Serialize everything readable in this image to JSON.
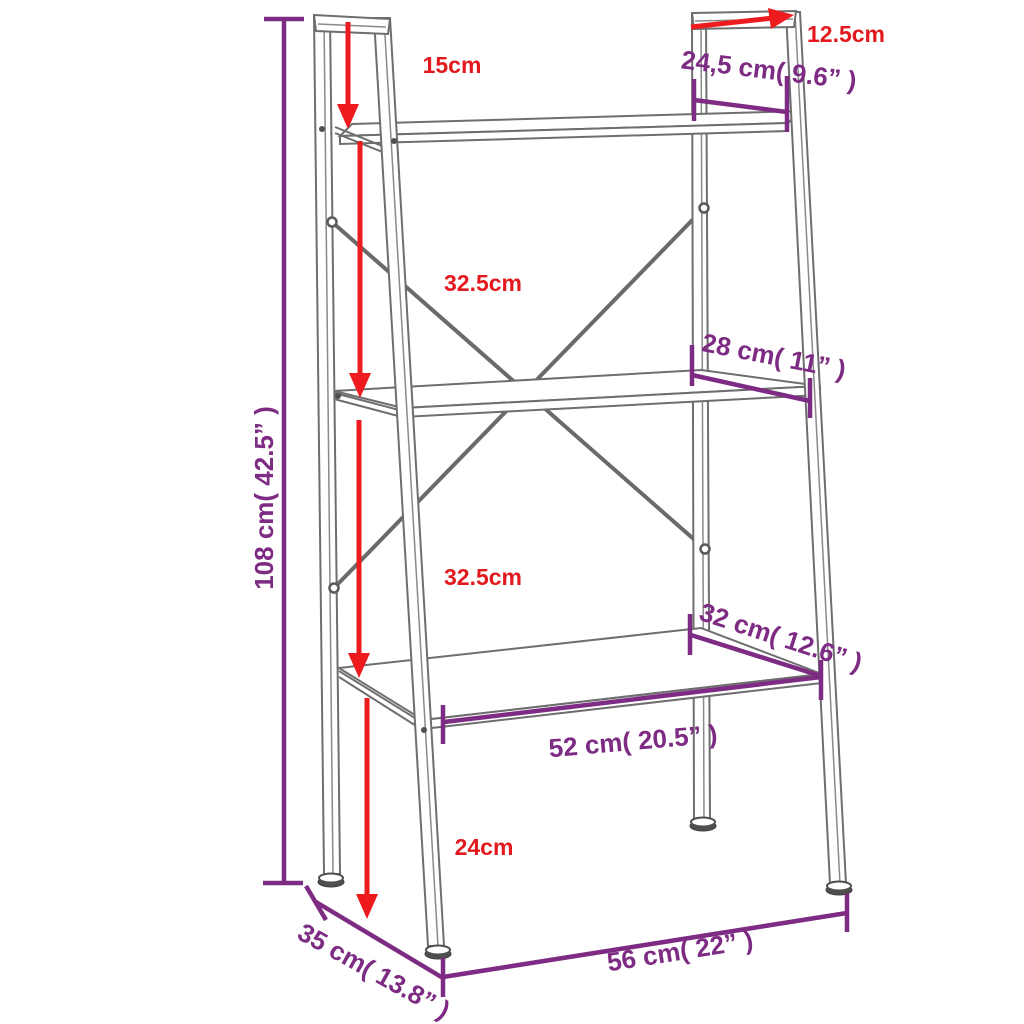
{
  "figure": {
    "background": "#ffffff",
    "colors": {
      "structure_gray": "#6e6e6e",
      "dimension_red": "#ee1b1e",
      "dimension_purple": "#7d2b83"
    }
  },
  "labels": {
    "total_height": "108 cm( 42.5” )",
    "top_clearance": "15cm",
    "top_rail_length": "12.5cm",
    "top_shelf_depth": "24,5 cm( 9.6” )",
    "upper_shelf_spacing": "32.5cm",
    "middle_shelf_depth": "28 cm( 11” )",
    "lower_shelf_spacing": "32.5cm",
    "bottom_shelf_depth": "32 cm( 12.6” )",
    "bottom_shelf_width": "52 cm( 20.5” )",
    "bottom_clearance": "24cm",
    "base_depth": "35 cm( 13.8” )",
    "base_width": "56 cm( 22” )"
  }
}
